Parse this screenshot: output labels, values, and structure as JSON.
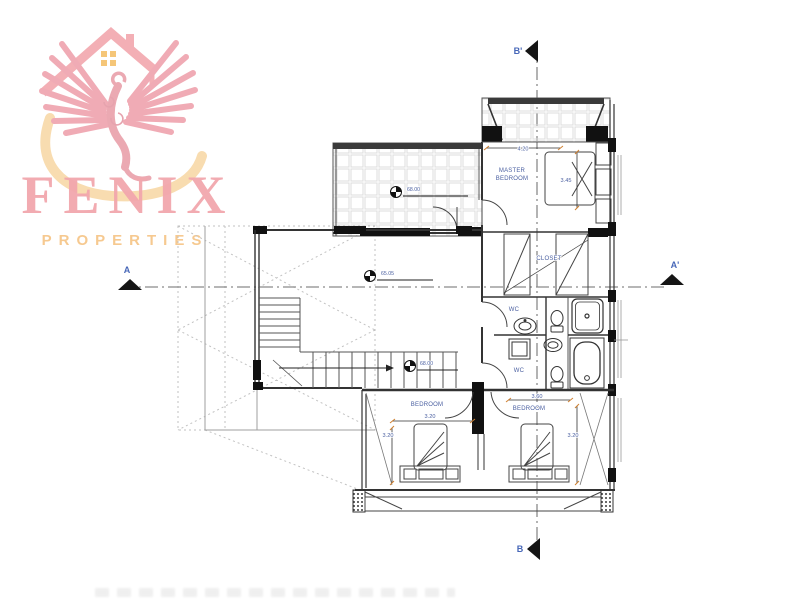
{
  "logo": {
    "name": "FENIX",
    "tagline": "PROPERTIES",
    "colors": {
      "pink": "#F2A7AD",
      "orange_text": "#F6C990",
      "swoosh": "#F8D9A8",
      "window_orange": "#F5C06A"
    }
  },
  "plan": {
    "sections": {
      "b_top": "B'",
      "b_bottom": "B",
      "a_left": "A",
      "a_right": "A'"
    },
    "rooms": {
      "master_line1": "MASTER",
      "master_line2": "BEDROOM",
      "closet": "CLOSET",
      "wc_upper": "WC",
      "wc_lower": "WC",
      "bedroom_left": "BEDROOM",
      "bedroom_right": "BEDROOM"
    },
    "dims": {
      "master_width": "4.20",
      "master_depth": "3.45",
      "bedroom_left_width": "3.20",
      "bedroom_left_depth": "3.20",
      "bedroom_right_width": "3.60",
      "bedroom_right_depth": "3.20"
    },
    "levels": {
      "terrace": "68.00",
      "living": "65.05",
      "stair": "68.00"
    },
    "colors": {
      "label_blue": "#4A5FA0",
      "accent_orange": "#D08030",
      "line_dark": "#2E2E2E"
    }
  }
}
